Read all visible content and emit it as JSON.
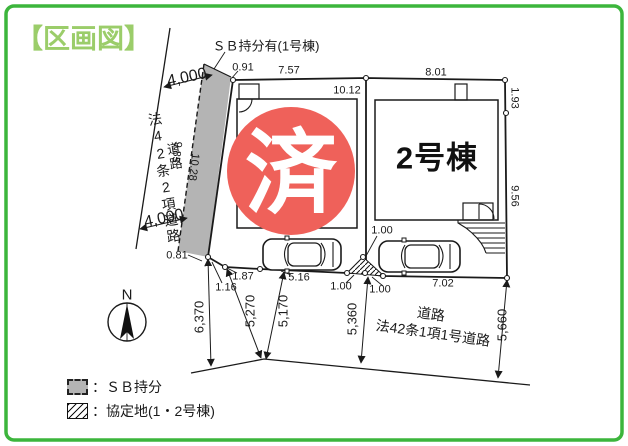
{
  "title": "【区画図】",
  "colors": {
    "border_green": "#3cb53c",
    "title_green": "#9bcd6a",
    "sold_red": "#ef615a",
    "strip_gray": "#b4b4b4",
    "line": "#1a1a1a"
  },
  "annotations": {
    "sb_note": "ＳＢ持分有(1号棟)",
    "sold_stamp": "済",
    "building2_label": "2号棟",
    "compass_north": "N"
  },
  "roads": {
    "left": {
      "name": "道路",
      "type": "法42条2項道路"
    },
    "south": {
      "name": "道路",
      "type": "法42条1項1号道路"
    }
  },
  "dimensions": {
    "road_left_width_top": "4,000",
    "road_left_width_bottom": "4,000",
    "strip_top_offset": "0.91",
    "strip_bottom_offset": "0.81",
    "strip_len_outer": "9.85",
    "strip_len_inner": "10.28",
    "parcel1_top": "7.57",
    "parcel2_top": "8.01",
    "parcel_divider": "10.12",
    "right_upper": "1.93",
    "right_lower": "9.56",
    "bottom_seg_187": "1.87",
    "bottom_seg_116": "1.16",
    "bottom_seg_516": "5.16",
    "bottom_seg_100_top": "1.00",
    "bottom_seg_100_left": "1.00",
    "bottom_seg_100_right": "1.00",
    "bottom_seg_702": "7.02",
    "road_width_6370": "6,370",
    "road_width_5270": "5,270",
    "road_width_5170": "5,170",
    "road_width_5360": "5,360",
    "road_width_5660": "5,660"
  },
  "legend": {
    "sb_label": "：ＳＢ持分",
    "kyotei_label": "：協定地(1・2号棟)"
  }
}
